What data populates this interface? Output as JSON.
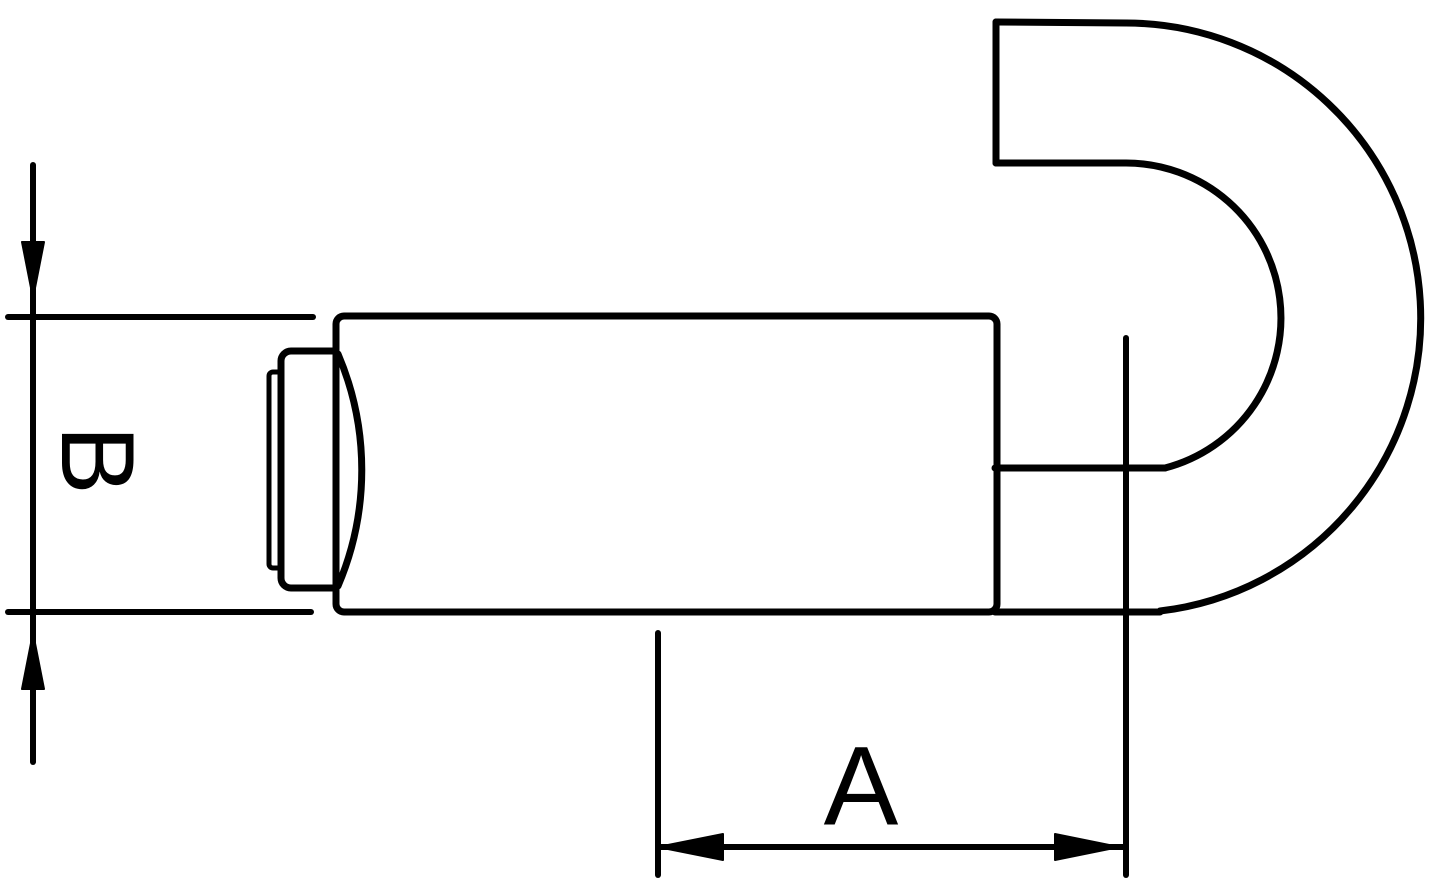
{
  "drawing": {
    "background_color": "#ffffff",
    "line_color": "#000000",
    "dimension_a": {
      "label": "A"
    },
    "dimension_b": {
      "label": "B"
    }
  }
}
